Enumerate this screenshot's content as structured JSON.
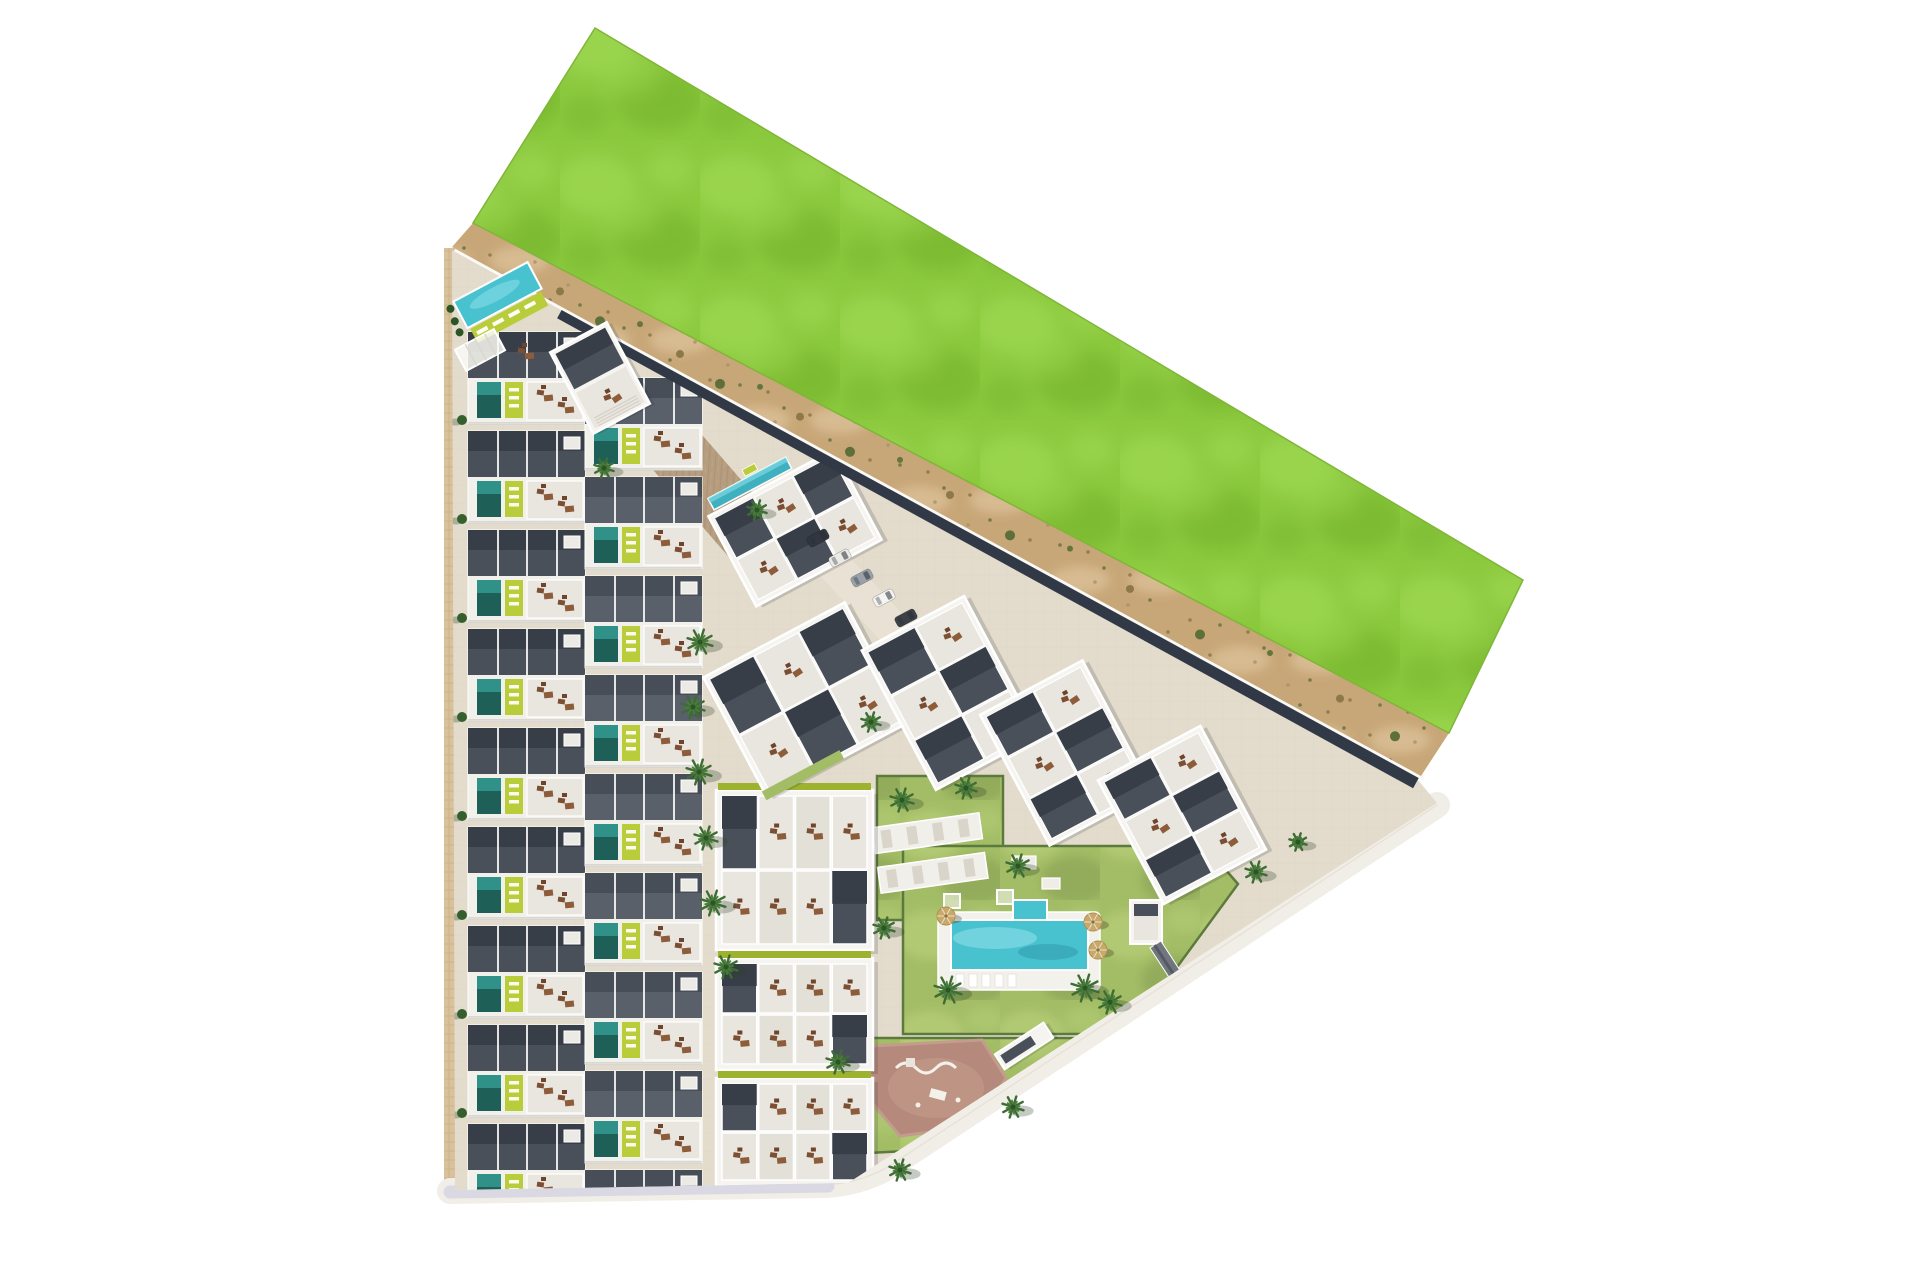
{
  "meta": {
    "type": "architectural-site-plan-aerial-render",
    "title": ""
  },
  "scene": {
    "canvas": {
      "w": 1920,
      "h": 1280
    },
    "colors": {
      "bg": "#ffffff",
      "grass1": "#8bc93e",
      "grass2": "#9ad44e",
      "grass3": "#7cba32",
      "grass_edge": "#7fb637",
      "sand1": "#c7a677",
      "sand2": "#dbc097",
      "speck1": "#8c7848",
      "speck2": "#66753e",
      "speck3": "#a9946a",
      "paving": "#e3dccd",
      "paving_line": "#d2c9b6",
      "sidewalk": "#d8c19b",
      "sidewalk_line": "#c3aa80",
      "road_white": "#f1eee7",
      "road_bottom": "#d9d8e3",
      "navy": "#323946",
      "wall_line": "#faf9f6",
      "roof_dark": "#4a505a",
      "roof_darker": "#383e48",
      "roof_mid": "#596069",
      "roof_dark2": "#484e58",
      "wall": "#f5f4f0",
      "terrace": "#e9e6df",
      "terrace_gray": "#d5d1c8",
      "pool_dark": "#1e5f57",
      "pool_mid": "#2f9187",
      "pool_bright": "#3fb0c0",
      "aqua": "#49c2d0",
      "aqua_light": "#7ed8e2",
      "aqua_shade": "#2b93a4",
      "lime": "#b9cd3a",
      "lime_dark": "#9db32f",
      "lawn": "#a3bd66",
      "lawn_light": "#b2cb74",
      "lawn_dark": "#8ea757",
      "hedge": "#5c7a3d",
      "palm": "#3c6e33",
      "palm2": "#4a7d3c",
      "palm_dark": "#2c5526",
      "furn1": "#7c4f33",
      "furn2": "#8d5c3b",
      "furn3": "#6e452c",
      "mauve": "#b58a7c",
      "mauve_light": "#c49c8d",
      "umbrella": "#c8a96a",
      "umbrella_rim": "#b08f52"
    },
    "green_field": {
      "points": "595,28 1523,580 1449,733 473,223"
    },
    "sand_strip": {
      "points": "473,223 1449,733 1421,776 452,247",
      "top_anchor": [
        473,
        223
      ],
      "slope": 0.522
    },
    "site": {
      "points": "452,250 1418,780 1437,803 848,1183 455,1190"
    },
    "boundary": {
      "wall": [
        455,
        249,
        1424,
        778
      ],
      "navy": [
        560,
        313,
        1416,
        783
      ]
    },
    "sidewalk": {
      "x": 444,
      "y": 248,
      "w": 26,
      "h": 944
    },
    "roads": {
      "main": "M450,1191 L826,1185 Q866,1182 894,1163 L1437,805",
      "bottom": [
        450,
        1192,
        828,
        1186
      ]
    },
    "tile_path": {
      "rect": [
        682,
        387,
        60,
        210
      ],
      "rot": -41,
      "cx": 712,
      "cy": 492
    },
    "driveway": [
      806,
      536,
      930,
      668
    ],
    "townhouses": {
      "left_x": 468,
      "right_x": 585,
      "top": 332,
      "right_offset": 46,
      "rows": 9,
      "step": 99,
      "unit_w": 117
    },
    "mid_buildings": [
      [
        716,
        790,
        157,
        160
      ],
      [
        716,
        958,
        157,
        112
      ],
      [
        716,
        1078,
        157,
        108
      ]
    ],
    "rotated_buildings": [
      {
        "name": "clubhouse-north-building",
        "cx": 795,
        "cy": 528,
        "w": 142,
        "h": 102,
        "rot": -28,
        "pool": true
      },
      {
        "name": "apartment-block-b1",
        "cx": 806,
        "cy": 700,
        "w": 160,
        "h": 136,
        "rot": -28,
        "fringe": true
      },
      {
        "name": "apartment-block-r1",
        "cx": 950,
        "cy": 693,
        "w": 116,
        "h": 158,
        "rot": -28
      },
      {
        "name": "apartment-block-r2",
        "cx": 1066,
        "cy": 753,
        "w": 116,
        "h": 148,
        "rot": -28
      },
      {
        "name": "apartment-block-r3",
        "cx": 1182,
        "cy": 815,
        "w": 116,
        "h": 140,
        "rot": -28
      }
    ],
    "gym": {
      "cx": 600,
      "cy": 378,
      "w": 64,
      "h": 92,
      "rot": -28
    },
    "lap_pool": {
      "cx": 498,
      "cy": 296,
      "rot": -28,
      "water": [
        456,
        280,
        84,
        30
      ],
      "lawn": [
        458,
        312,
        80,
        16
      ]
    },
    "pergola": {
      "cx": 480,
      "cy": 350,
      "rot": -28,
      "rect": [
        458,
        338,
        44,
        24
      ]
    },
    "lawns": [
      {
        "name": "lawn-upper",
        "points": "877,776 1003,776 1003,920 877,920"
      },
      {
        "name": "lawn-pool",
        "points": "903,846 1205,846 1238,884 1128,1034 903,1034"
      },
      {
        "name": "lawn-playground",
        "points": "848,1038 1088,1038 926,1150 848,1154"
      }
    ],
    "playground": {
      "points": "872,1046 982,1040 1006,1078 976,1126 900,1136 868,1098"
    },
    "main_pool": {
      "deck": [
        938,
        912,
        162,
        78
      ],
      "water": [
        951,
        920,
        137,
        50
      ],
      "ext": [
        1013,
        900,
        34,
        22
      ],
      "loungers_x": 956,
      "loungers_y": 974,
      "lounger_n": 5
    },
    "planters": [
      [
        1012,
        856,
        24,
        13
      ],
      [
        1042,
        878,
        18,
        11
      ]
    ],
    "sun_decks": {
      "rot": -8,
      "cx": 930,
      "cy": 853,
      "rects": [
        [
          876,
          820,
          108,
          26
        ],
        [
          876,
          860,
          108,
          26
        ]
      ]
    },
    "o_building": {
      "rot": -33,
      "cx": 1024,
      "cy": 1046,
      "rect": [
        995,
        1037,
        58,
        18
      ]
    },
    "p_building": {
      "rect": [
        1130,
        900,
        32,
        44
      ],
      "ramp": {
        "rot": -33,
        "cx": 1170,
        "cy": 966,
        "rect": [
          1163,
          940,
          13,
          52
        ]
      }
    },
    "cars": {
      "rot": 62,
      "items": [
        [
          818,
          538,
          "#32373f"
        ],
        [
          840,
          558,
          "#eceae6"
        ],
        [
          862,
          578,
          "#9aa1a8"
        ],
        [
          884,
          598,
          "#f4f4f2"
        ],
        [
          906,
          618,
          "#3c4148"
        ]
      ]
    },
    "road_dashes": [
      [
        872,
        648
      ],
      [
        880,
        655
      ],
      [
        888,
        662
      ]
    ],
    "bench": {
      "x": 742,
      "y": 470,
      "rot": -28
    },
    "umbrellas": [
      [
        1093,
        922
      ],
      [
        1098,
        950
      ],
      [
        946,
        916
      ]
    ],
    "palms": [
      [
        700,
        642,
        13
      ],
      [
        693,
        707,
        12
      ],
      [
        699,
        772,
        13
      ],
      [
        706,
        838,
        12
      ],
      [
        713,
        903,
        13
      ],
      [
        726,
        967,
        12
      ],
      [
        902,
        800,
        12
      ],
      [
        966,
        788,
        11
      ],
      [
        871,
        722,
        10
      ],
      [
        884,
        928,
        11
      ],
      [
        948,
        990,
        14
      ],
      [
        1085,
        988,
        14
      ],
      [
        1018,
        866,
        12
      ],
      [
        1110,
        1002,
        12
      ],
      [
        838,
        1062,
        12
      ],
      [
        1013,
        1107,
        11
      ],
      [
        900,
        1170,
        11
      ],
      [
        757,
        510,
        10
      ],
      [
        604,
        468,
        10
      ],
      [
        1256,
        872,
        11
      ],
      [
        1298,
        842,
        9
      ]
    ],
    "bush_xs": [
      527,
      560,
      600,
      640,
      680,
      720,
      760,
      800,
      850,
      900,
      950,
      1010,
      1070,
      1130,
      1200,
      1270,
      1340,
      1395
    ]
  }
}
